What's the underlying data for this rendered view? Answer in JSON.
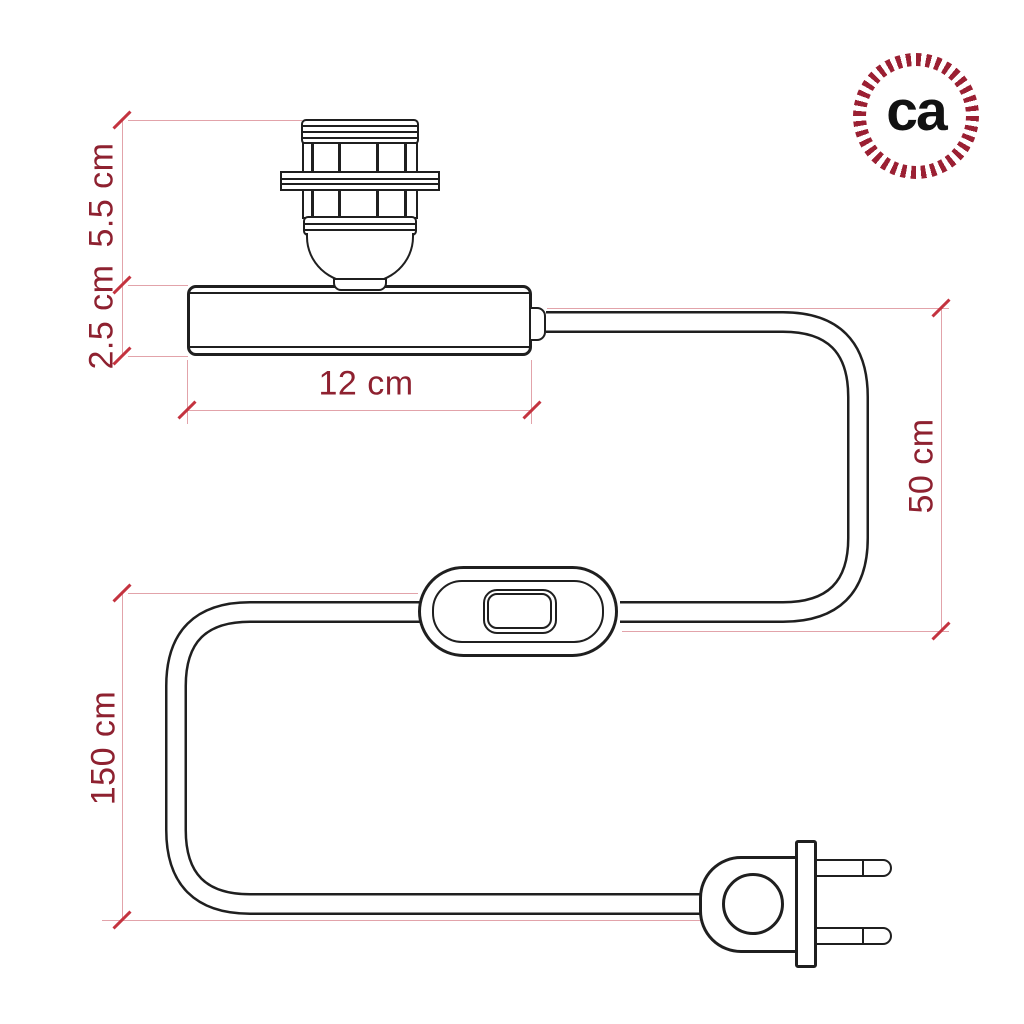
{
  "logo": {
    "text": "ca",
    "ring_color": "#9b2033",
    "text_color": "#121212"
  },
  "dimensions": {
    "socket_height": "5.5 cm",
    "base_height": "2.5 cm",
    "base_width": "12 cm",
    "base_to_switch_cable": "50 cm",
    "switch_to_plug_cable": "150 cm"
  },
  "colors": {
    "drawing_line": "#1f1f1f",
    "dimension_line": "#e2a3aa",
    "dimension_tick": "#c4333f",
    "dimension_text": "#8e2130",
    "background": "#ffffff"
  }
}
